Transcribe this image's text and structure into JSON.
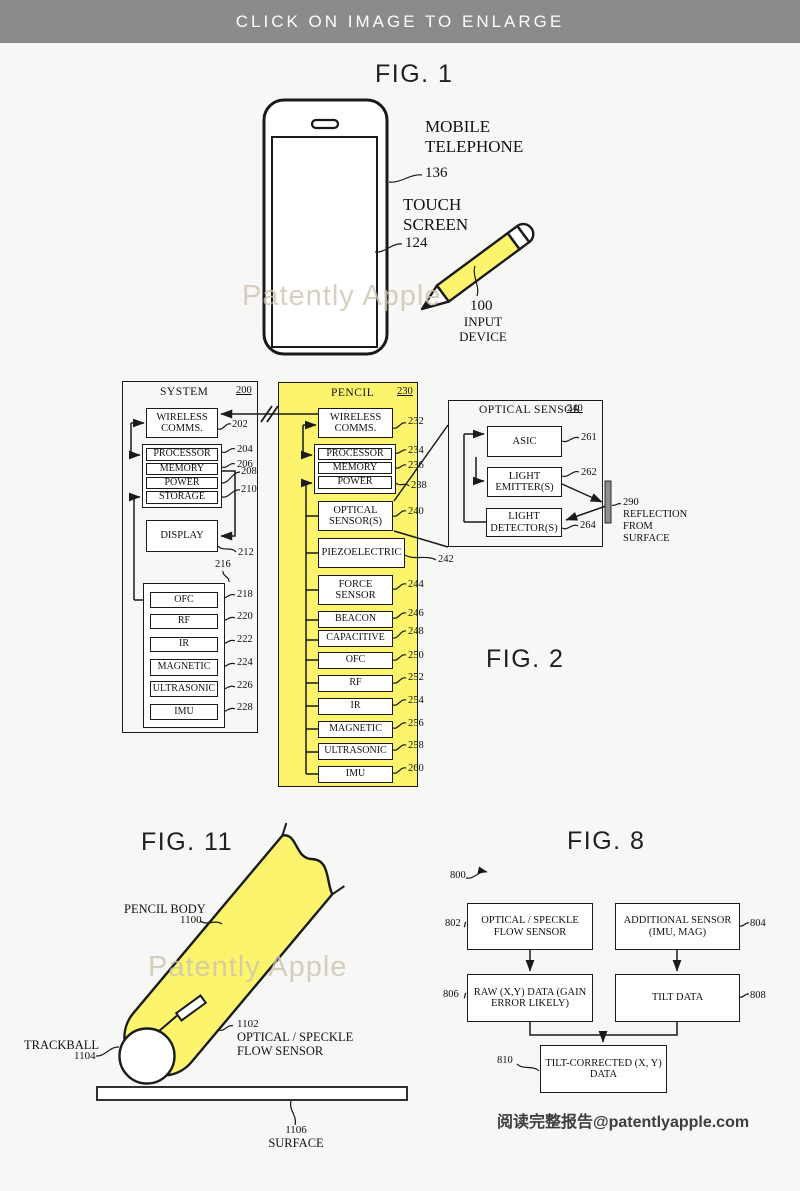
{
  "colors": {
    "highlight_yellow": "#FBF46C",
    "banner_gray": "#8B8B8B"
  },
  "banner": {
    "text": "CLICK ON IMAGE TO ENLARGE"
  },
  "fig1": {
    "title": "FIG. 1",
    "watermark": "Patently Apple",
    "mobile": {
      "label": "MOBILE TELEPHONE",
      "ref": "136"
    },
    "touch": {
      "label": "TOUCH SCREEN",
      "ref": "124"
    },
    "input": {
      "ref": "100",
      "label": "INPUT DEVICE"
    }
  },
  "fig2": {
    "title": "FIG. 2",
    "system": {
      "title": "SYSTEM",
      "ref": "200",
      "comms": {
        "label": "WIRELESS COMMS.",
        "ref": "202"
      },
      "core": [
        {
          "label": "PROCESSOR",
          "ref": "204"
        },
        {
          "label": "MEMORY",
          "ref": "206"
        },
        {
          "label": "POWER",
          "ref": "208"
        },
        {
          "label": "STORAGE",
          "ref": "210"
        }
      ],
      "display": {
        "label": "DISPLAY",
        "ref": "212"
      },
      "sensor_group_ref": "216",
      "sensors": [
        {
          "label": "OFC",
          "ref": "218"
        },
        {
          "label": "RF",
          "ref": "220"
        },
        {
          "label": "IR",
          "ref": "222"
        },
        {
          "label": "MAGNETIC",
          "ref": "224"
        },
        {
          "label": "ULTRASONIC",
          "ref": "226"
        },
        {
          "label": "IMU",
          "ref": "228"
        }
      ]
    },
    "pencil": {
      "title": "PENCIL",
      "ref": "230",
      "comms": {
        "label": "WIRELESS COMMS.",
        "ref": "232"
      },
      "core": [
        {
          "label": "PROCESSOR",
          "ref": "234"
        },
        {
          "label": "MEMORY",
          "ref": "236"
        },
        {
          "label": "POWER",
          "ref": "238"
        }
      ],
      "modules": [
        {
          "label": "OPTICAL SENSOR(S)",
          "ref": "240"
        },
        {
          "label": "PIEZOELECTRIC",
          "ref": "242"
        },
        {
          "label": "FORCE SENSOR",
          "ref": "244"
        },
        {
          "label": "BEACON",
          "ref": "246"
        },
        {
          "label": "CAPACITIVE",
          "ref": "248"
        },
        {
          "label": "OFC",
          "ref": "250"
        },
        {
          "label": "RF",
          "ref": "252"
        },
        {
          "label": "IR",
          "ref": "254"
        },
        {
          "label": "MAGNETIC",
          "ref": "256"
        },
        {
          "label": "ULTRASONIC",
          "ref": "258"
        },
        {
          "label": "IMU",
          "ref": "260"
        }
      ]
    },
    "optical": {
      "title": "OPTICAL SENSOR",
      "ref": "240",
      "parts": [
        {
          "label": "ASIC",
          "ref": "261"
        },
        {
          "label": "LIGHT EMITTER(S)",
          "ref": "262"
        },
        {
          "label": "LIGHT DETECTOR(S)",
          "ref": "264"
        }
      ],
      "reflection": {
        "ref": "290",
        "label": "REFLECTION FROM SURFACE"
      }
    }
  },
  "fig11": {
    "title": "FIG. 11",
    "watermark": "Patently Apple",
    "body": {
      "label": "PENCIL BODY",
      "ref": "1100"
    },
    "trackball": {
      "label": "TRACKBALL",
      "ref": "1104"
    },
    "sensor": {
      "ref": "1102",
      "label": "OPTICAL / SPECKLE FLOW SENSOR"
    },
    "surface": {
      "ref": "1106",
      "label": "SURFACE"
    }
  },
  "fig8": {
    "title": "FIG. 8",
    "ref": "800",
    "boxes": [
      {
        "label": "OPTICAL / SPECKLE FLOW SENSOR",
        "ref": "802"
      },
      {
        "label": "ADDITIONAL SENSOR (IMU, MAG)",
        "ref": "804"
      },
      {
        "label": "RAW (X,Y) DATA (GAIN ERROR LIKELY)",
        "ref": "806"
      },
      {
        "label": "TILT DATA",
        "ref": "808"
      },
      {
        "label": "TILT-CORRECTED (X, Y) DATA",
        "ref": "810"
      }
    ]
  },
  "footer": {
    "text": "阅读完整报告@patentlyapple.com"
  }
}
